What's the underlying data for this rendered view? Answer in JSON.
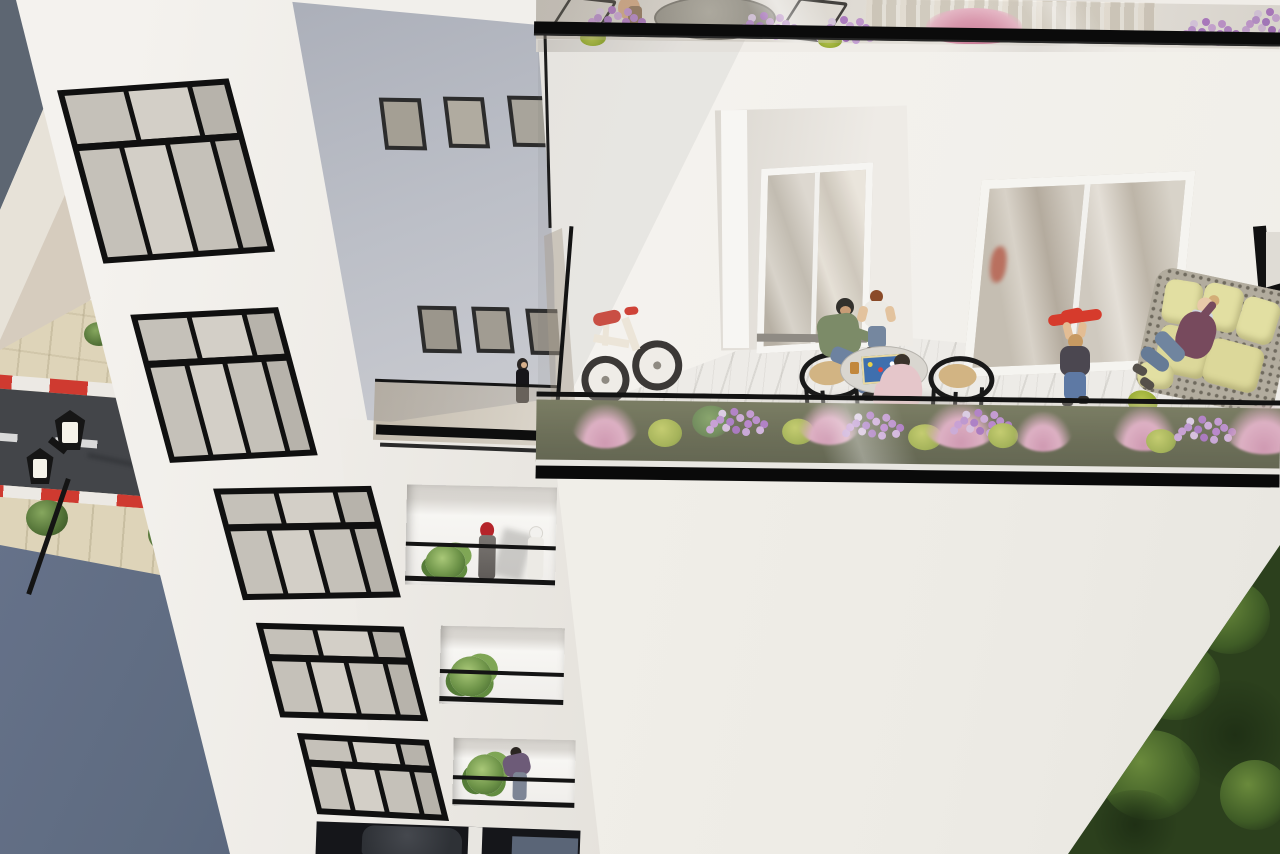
{
  "meta": {
    "title": "Aerial 3D architectural rendering of a white apartment building with roof terrace",
    "description": "High-angle photorealistic visualization: a white residential tower with black-framed windows and recessed balconies on the left, a street with a lamp post below, and a large roof terrace on the right where residents relax among flower planters.",
    "render_style": "photorealistic 3D architectural visualization",
    "camera_view": "high-angle aerial / bird's-eye"
  },
  "palette": {
    "wall-white": "#f1efeb",
    "wall-shadow": "#e2dfd9",
    "gray-wall": "#b9bcc4",
    "frame-black": "#111111",
    "glass-gray": "#c5c1b9",
    "glass-tint": "rgba(168,156,136,0.55)",
    "marble": "#edebe7",
    "asphalt": "#434549",
    "curb-red": "#cf3a30",
    "sidewalk": "#ded4b9",
    "slate-roof": "#5d6672",
    "slate-blue": "#5e6b80",
    "soil-green": "#474c31",
    "grass-pink": "#e2a6c4",
    "flower-purple": "#b785d6",
    "bush-green": "#93a832",
    "foliage-dark": "#2c401d",
    "sofa-cushion": "#e2dfa2",
    "plum-sweater": "#774a5d",
    "jeans-blue": "#70859f",
    "skin": "#e9c9a8",
    "hijab-red": "#b5242a",
    "green-sweater": "#7c8b68",
    "pink-shirt": "#e5c6ca",
    "red-toy": "#d63b2c"
  },
  "scene": {
    "street": {
      "label": "street below with lamp post, dashed center line, red-and-white curbs, sidewalk trees and a blue-gray roof",
      "lamp": "black double-headed ornamental street lamp seen from above",
      "markings": [
        "white dashed center line",
        "red-white striped curb near side",
        "red-white striped curb far side"
      ],
      "trees": 3
    },
    "left_building": {
      "label": "white facade with five large black-framed windows and a column of recessed balconies",
      "large_windows": 5,
      "small_gray_wall_windows": 6,
      "walkway": "tinted glass balustrade walkway with a woman in black walking",
      "balconies": [
        {
          "occupants": "woman in red headscarf and a figure in white beside a potted plant"
        },
        {
          "occupants": "potted green plant"
        },
        {
          "occupants": "man in purple sweater leaning on the railing beside a plant"
        }
      ],
      "ground": "dark garage opening with a parked car"
    },
    "terrace_building": {
      "label": "large roof terrace with glass balustrade and flower planter",
      "upper_floor": "floor above with bistro table, black chairs, seated person, flower boxes and cream french doors behind a glass balustrade",
      "doors": [
        "recessed white french door alcove",
        "wide glass french door with reflections",
        "partial dark-framed opening at right edge"
      ],
      "terrace_items": [
        "child's balance bike with red saddle leaning on the wall",
        "two black wishbone chairs with woven seats",
        "round table with a board game and drinks",
        "rattan sofa with pale yellow cushions"
      ],
      "people": [
        {
          "id": "seated-man-green",
          "desc": "man in green sweater and jeans seated at the table"
        },
        {
          "id": "standing-boy",
          "desc": "boy in white t-shirt standing at the table"
        },
        {
          "id": "seated-man-pink",
          "desc": "man in pale pink shirt seated with his back turned"
        },
        {
          "id": "child-plane",
          "desc": "child in dark jacket holding up a red toy glider"
        },
        {
          "id": "woman-phone",
          "desc": "blonde woman in plum sweater talking on the phone on the sofa"
        }
      ],
      "planter": {
        "desc": "long glass-fronted planter with dark soil",
        "plants": [
          "pink muhly grass clumps",
          "purple flower clusters",
          "yellow-green bushes",
          "green fern"
        ]
      },
      "lower_facade": "large blank white wall",
      "corner_foliage": "dark green tree canopy in the bottom-right corner"
    }
  }
}
